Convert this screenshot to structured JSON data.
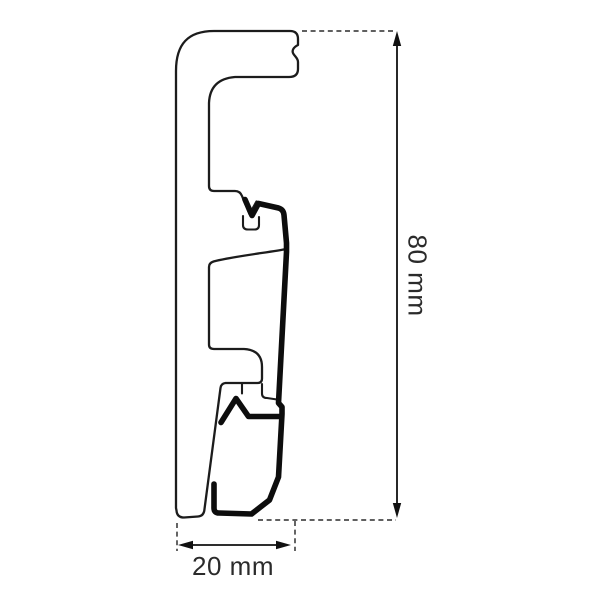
{
  "drawing": {
    "type": "technical-profile-cross-section",
    "subject": "skirting-board-profile-with-mounting-clip",
    "background_color": "#ffffff",
    "outline_color": "#1c1c1c",
    "clip_rail_color": "#0d0d0d",
    "extension_line_color": "#4a4a4a",
    "label_color": "#2b2b2b"
  },
  "dimensions": {
    "height_label": "80 mm",
    "width_label": "20 mm"
  }
}
